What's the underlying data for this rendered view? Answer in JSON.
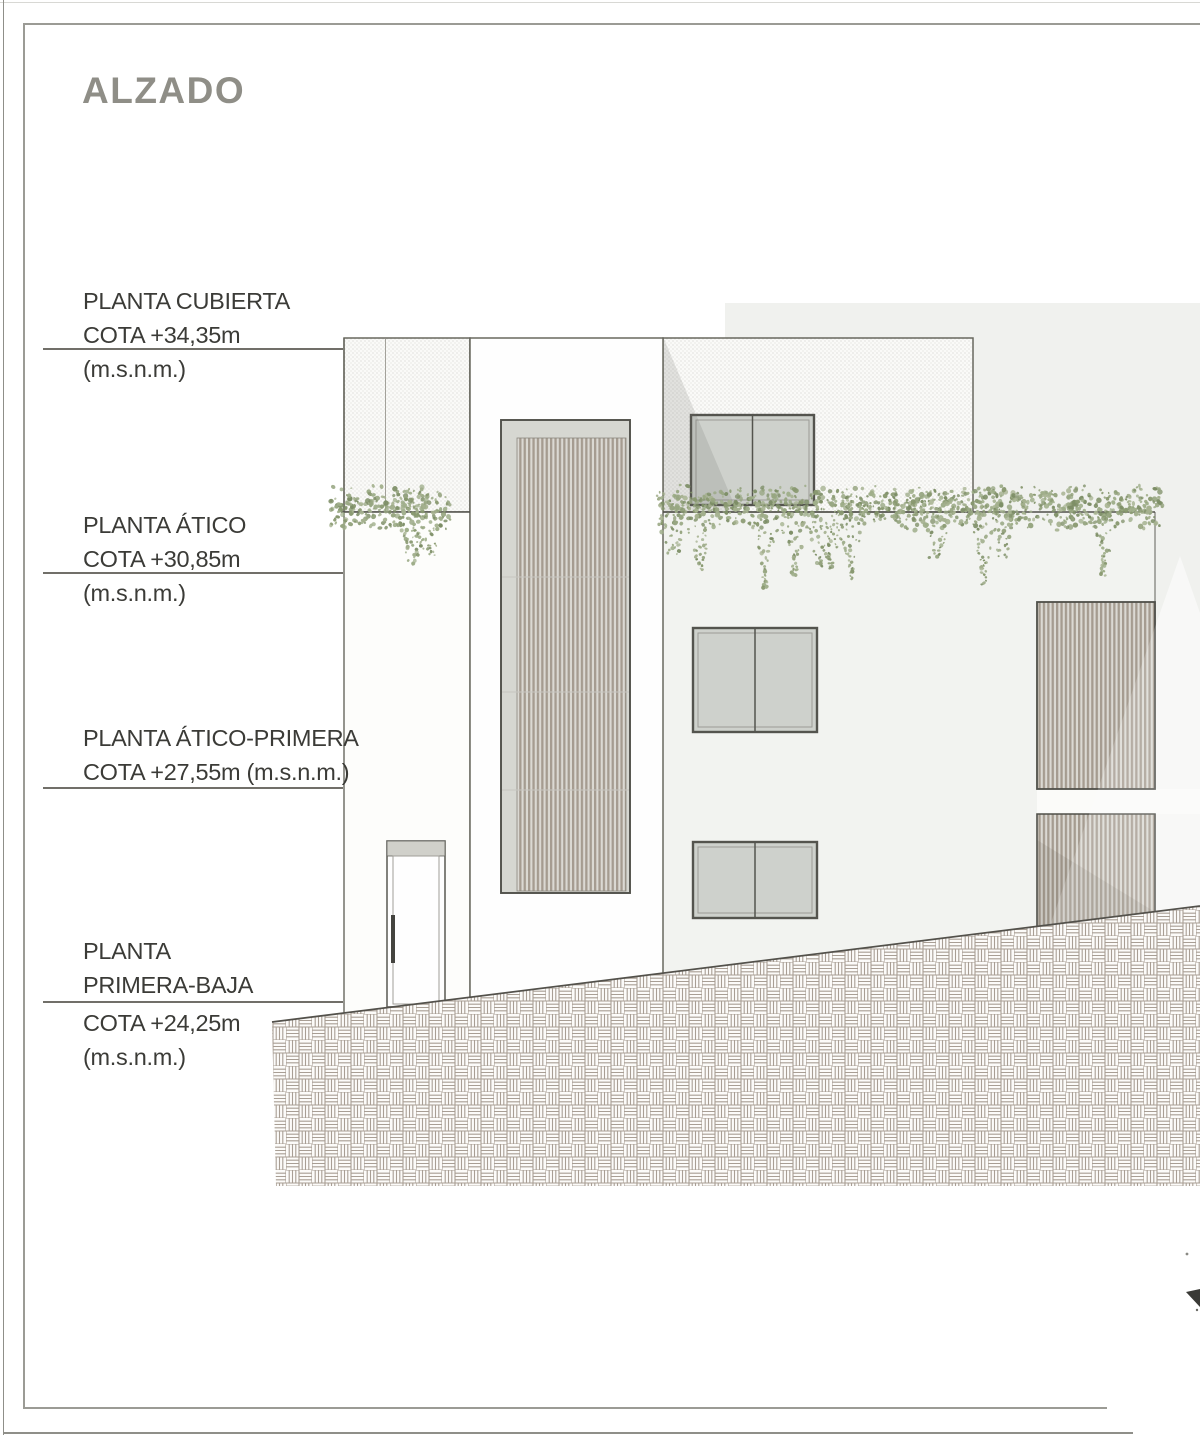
{
  "title": "ALZADO",
  "levels": [
    {
      "name": "PLANTA CUBIERTA",
      "cota": "COTA +34,35m",
      "unit": "(m.s.n.m.)"
    },
    {
      "name": "PLANTA ÁTICO",
      "cota": "COTA +30,85m",
      "unit": "(m.s.n.m.)"
    },
    {
      "name": "PLANTA ÁTICO-PRIMERA",
      "cota": "COTA +27,55m (m.s.n.m.)",
      "unit": ""
    },
    {
      "name_l1": "PLANTA",
      "name_l2": "PRIMERA-BAJA",
      "cota": "COTA +24,25m",
      "unit": "(m.s.n.m.)"
    }
  ],
  "drawing": {
    "type": "architectural-elevation",
    "elements": [
      "left-tower",
      "central-tower",
      "penthouse",
      "right-building",
      "louver-screens",
      "windows",
      "entrance-door",
      "planter-foliage",
      "sloped-ground-hatch"
    ],
    "colors": {
      "ink": "#3b3b37",
      "title_gray": "#8f8e87",
      "outline": "#68685f",
      "level_line": "#716f69",
      "louver_slat": "#a59c90",
      "window_glass": "#ced1cc",
      "foliage_green": "#97a681",
      "ground_hatch_line": "#a89e94",
      "backdrop_gray": "#f0f1ee"
    }
  }
}
